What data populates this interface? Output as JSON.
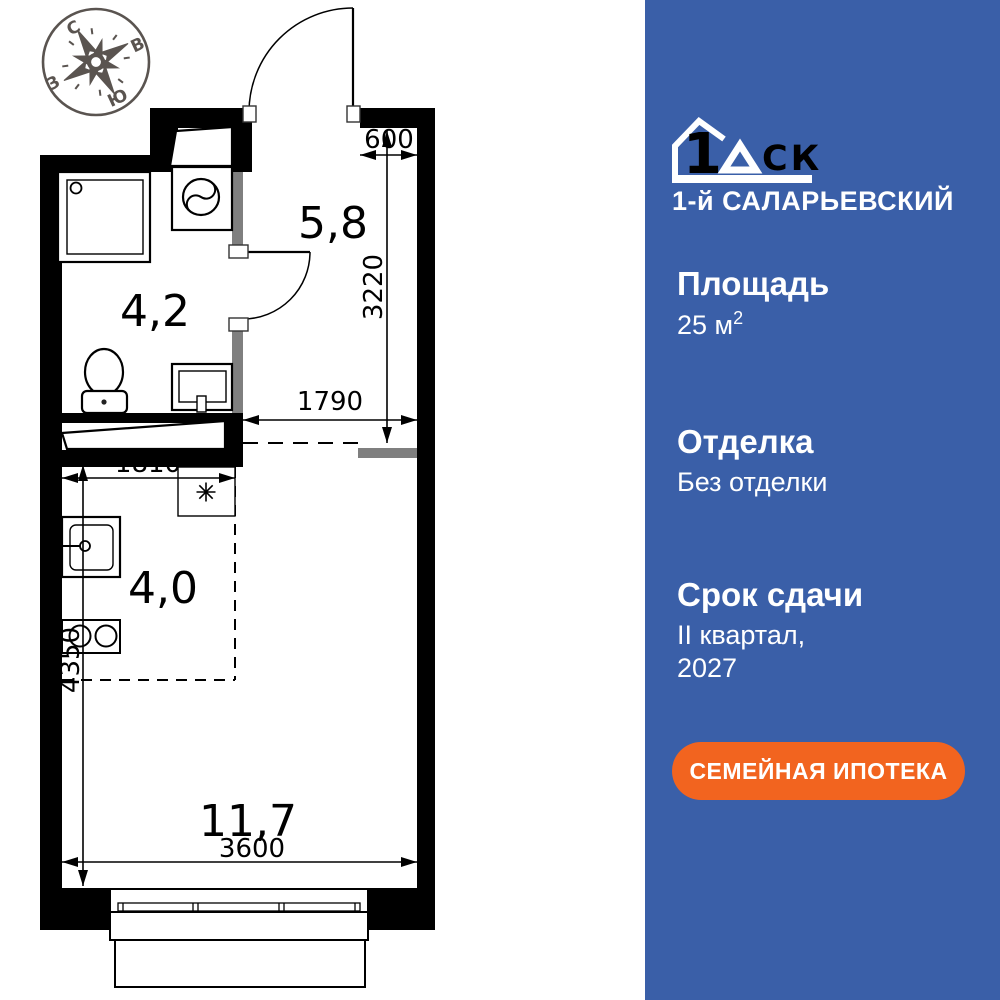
{
  "compass": {
    "n": "С",
    "e": "В",
    "w": "З",
    "s": "Ю"
  },
  "plan": {
    "areas": {
      "hallway": "5,8",
      "bathroom": "4,2",
      "kitchen": "4,0",
      "living": "11,7"
    },
    "dims": {
      "d600": "600",
      "d3220": "3220",
      "d1790": "1790",
      "d1810": "1810",
      "d4350": "4350",
      "d3600": "3600"
    }
  },
  "panel": {
    "logo": {
      "one": "1",
      "d": "Д",
      "sk": "СК",
      "project": "1-й САЛАРЬЕВСКИЙ"
    },
    "area_label": "Площадь",
    "area_value": "25 м",
    "area_sup": "2",
    "finish_label": "Отделка",
    "finish_value": "Без отделки",
    "deadline_label": "Срок сдачи",
    "deadline_line1": "II квартал,",
    "deadline_line2": "2027",
    "button_label": "СЕМЕЙНАЯ ИПОТЕКА",
    "colors": {
      "bg": "#3A5FA8",
      "button": "#F2641F"
    }
  }
}
